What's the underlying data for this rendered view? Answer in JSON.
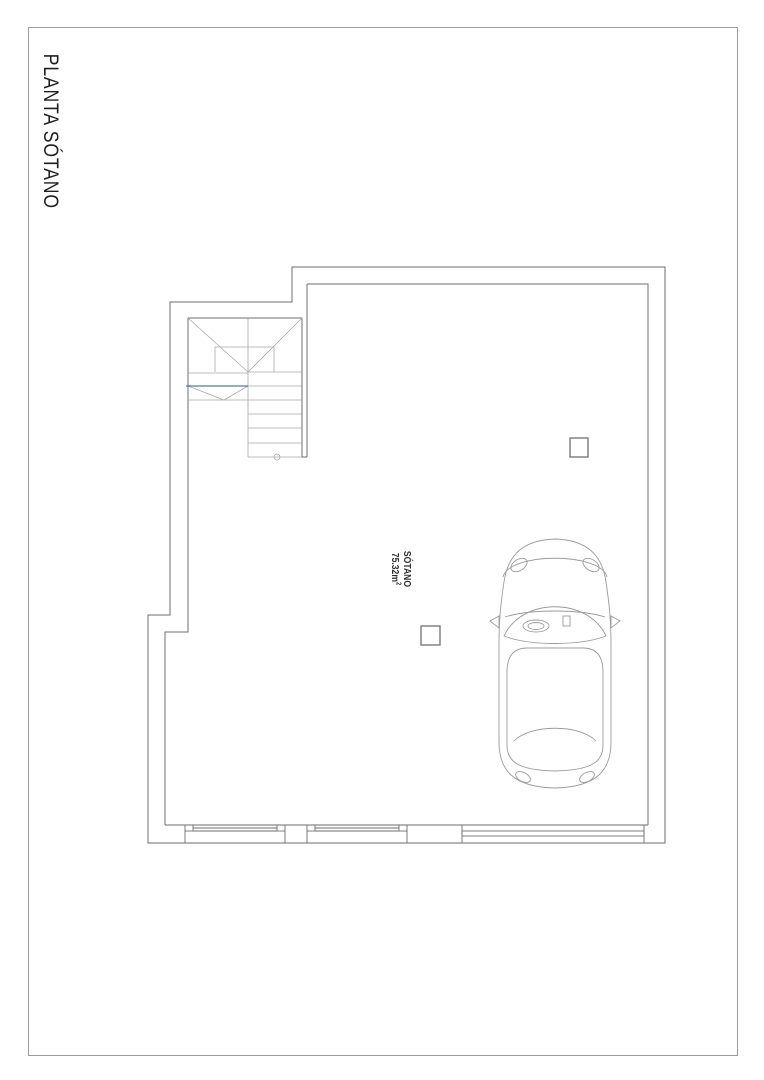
{
  "page": {
    "title": "PLANTA SÓTANO"
  },
  "plan": {
    "room": {
      "name": "SÓTANO",
      "area_base": "75.32m",
      "area_exponent": "2"
    },
    "colors": {
      "wall_line": "#6e6e6e",
      "detail_line": "#a9a9a9",
      "car_line": "#9b9b9b",
      "column_line": "#7a7a7a",
      "stair_accent": "#4d7d94",
      "frame": "#9c9c9c",
      "text": "#1f1f1f"
    }
  }
}
